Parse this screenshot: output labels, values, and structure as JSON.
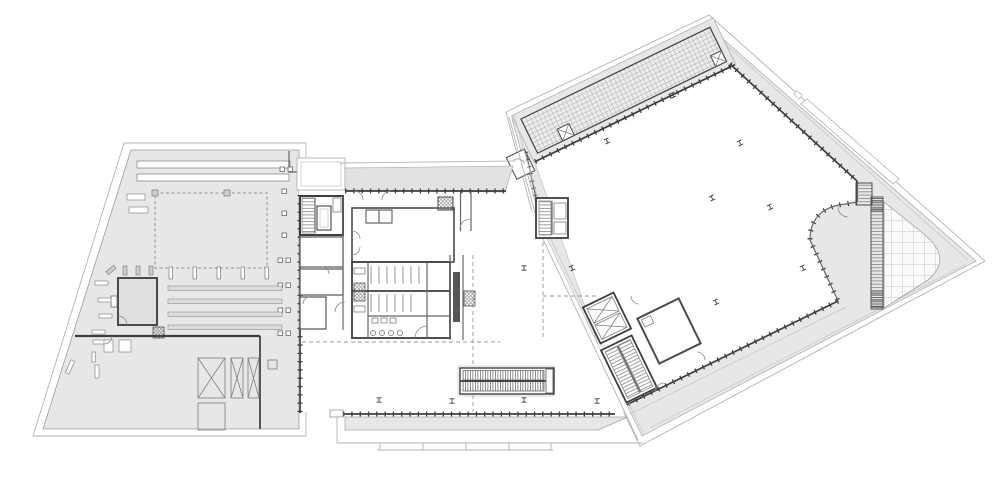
{
  "canvas": {
    "width": 1000,
    "height": 490,
    "background": "#ffffff"
  },
  "drawing": {
    "kind": "architectural-floor-plan",
    "text_labels_visible": []
  },
  "colors": {
    "paper": "#ffffff",
    "site_fill": "#e7e7e7",
    "canopy_fill": "#e2e2e2",
    "floor_fill": "#ffffff",
    "room_fill": "#e0e0e0",
    "terrace_fill": "#fafafa",
    "outline": "#b3b3b3",
    "midline": "#8c8c8c",
    "wall": "#3d3d3d",
    "hatch_line": "#9a9a9a",
    "grid_cell": "#ececec",
    "terrace_grid_line": "#b5b5b5"
  },
  "sections": {
    "west_parcel": {
      "name": "west-parcel",
      "features": [
        "roof-slot-bars",
        "dashed-room-outline",
        "plant-room",
        "parking-stripes",
        "cross-braced-crates",
        "storage-square",
        "column-markers",
        "perimeter-boundary"
      ]
    },
    "central_building": {
      "name": "central-building",
      "features": [
        "entrance-canopy",
        "stair-core",
        "elevator-shaft",
        "restrooms",
        "washbasins",
        "escalators",
        "service-shaft",
        "lower-terrace",
        "sidewalk-joints",
        "column-markers",
        "curtain-wall-ticks"
      ]
    },
    "east_parcel": {
      "name": "east-hall",
      "features": [
        "louvre-grid-roof",
        "exhibition-hall",
        "curved-terrace-pocket",
        "terrace-grid",
        "ladder-louvre-strip",
        "stair-blocks",
        "column-markers",
        "site-boundary",
        "skylight-strip"
      ]
    }
  },
  "counts": {
    "column_markers_central": 5,
    "column_markers_east_hall": 8,
    "cross_braced_crates": 3,
    "escalator_runs": 2
  }
}
